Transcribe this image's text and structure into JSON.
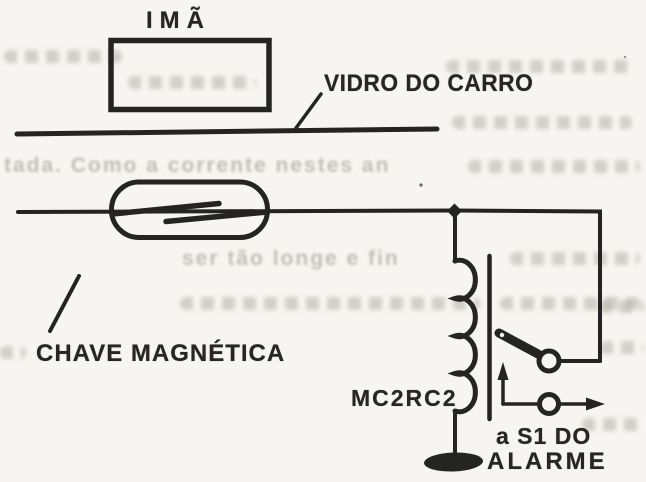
{
  "figure": {
    "kind": "scanned circuit schematic (car-alarm reed switch sensor)",
    "labels": {
      "magnet": "IMÃ",
      "car_glass": "VIDRO DO CARRO",
      "magnetic_switch": "CHAVE MAGNÉTICA",
      "relay_coil": "MC2RC2",
      "alarm_dest_line1": "a S1 DO",
      "alarm_dest_line2": "ALARME"
    },
    "colors": {
      "ink": "#242422",
      "paper": "#f6f5f1",
      "bleedthrough": "#aeaca4"
    }
  },
  "bleedthrough": {
    "fragments": [
      {
        "text": "",
        "x": 4,
        "y": 50,
        "w": 118
      },
      {
        "text": "",
        "x": 128,
        "y": 76,
        "w": 128
      },
      {
        "text": "",
        "x": 446,
        "y": 60,
        "w": 186
      },
      {
        "text": "",
        "x": 452,
        "y": 116,
        "w": 180
      },
      {
        "text": "tada. Como a corrente nestes an",
        "x": 4,
        "y": 155,
        "w": 0
      },
      {
        "text": "",
        "x": 468,
        "y": 160,
        "w": 172
      },
      {
        "text": "ser  tão longe e fin",
        "x": 182,
        "y": 248,
        "w": 0
      },
      {
        "text": "",
        "x": 510,
        "y": 252,
        "w": 130
      },
      {
        "text": "",
        "x": 180,
        "y": 297,
        "w": 300
      },
      {
        "text": "",
        "x": 500,
        "y": 297,
        "w": 140
      },
      {
        "text": "",
        "x": 0,
        "y": 346,
        "w": 26
      },
      {
        "text": "",
        "x": 600,
        "y": 341,
        "w": 44
      },
      {
        "text": "",
        "x": 598,
        "y": 300,
        "w": 46
      },
      {
        "text": "",
        "x": 582,
        "y": 418,
        "w": 60
      }
    ]
  }
}
